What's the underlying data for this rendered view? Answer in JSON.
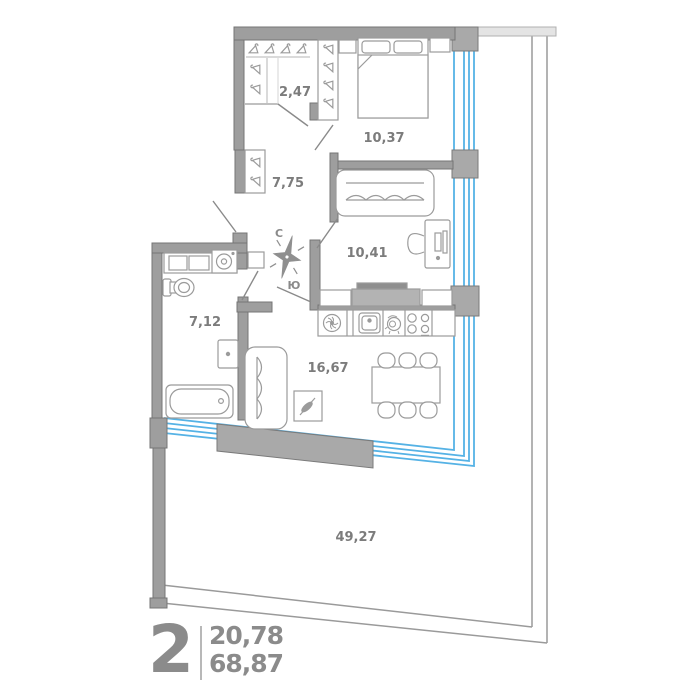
{
  "title": "2-room apartment floor plan",
  "summary": {
    "rooms_count": "2",
    "area_living": "20,78",
    "area_total": "68,87"
  },
  "compass": {
    "north_label": "С",
    "south_label": "Ю"
  },
  "room_areas": {
    "wardrobe": "2,47",
    "bedroom": "10,37",
    "hall": "7,75",
    "study": "10,41",
    "bathroom": "7,12",
    "kitchen_living": "16,67",
    "terrace": "49,27"
  },
  "colors": {
    "wall": "#9e9e9e",
    "wall_outline": "#757575",
    "wall_light": "#e4e4e4",
    "glazing_blue": "#55b2e5",
    "furniture_line": "#9b9b9b",
    "furniture_gray": "#b3b3b3",
    "label_gray": "#7c7c7c",
    "summary_gray": "#8b8b8b"
  }
}
